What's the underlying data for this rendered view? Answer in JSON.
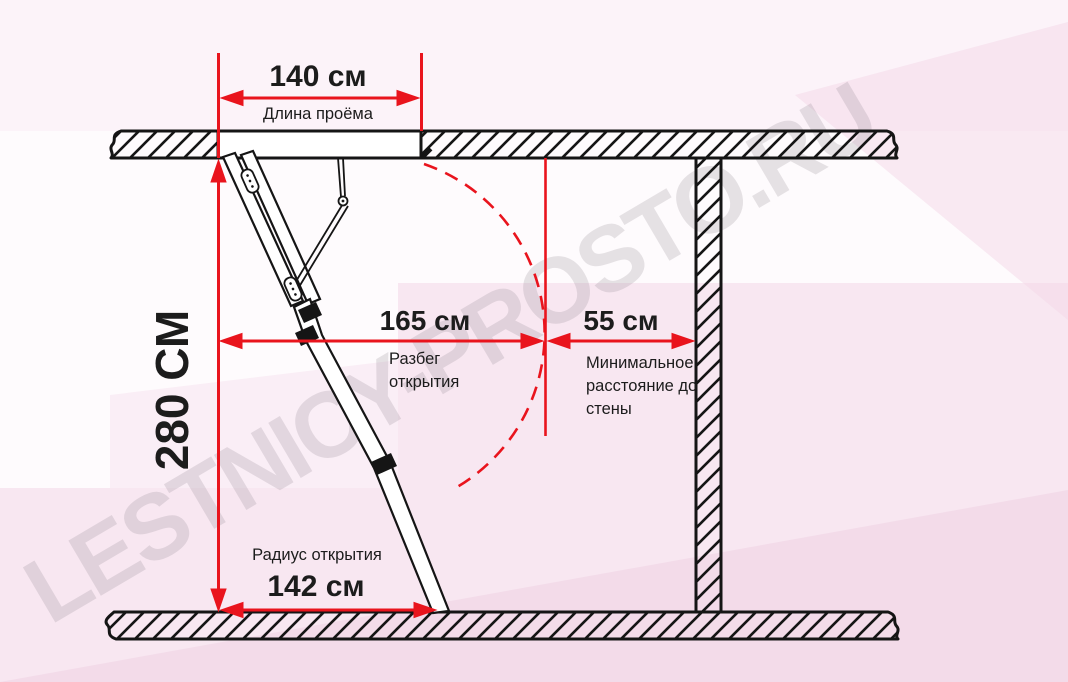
{
  "watermark": {
    "text": "LESTNICY-PROSTO.RU"
  },
  "colors": {
    "dimension_red": "#e9141d",
    "line_black": "#151515",
    "background_pink": "#f3d9e9",
    "watermark_gray": "#e5dfe4"
  },
  "dimensions": {
    "opening_length": {
      "value": "140 см",
      "label": "Длина проёма"
    },
    "ceiling_height": {
      "value": "280 СМ"
    },
    "opening_span": {
      "value": "165 см",
      "label": "Разбег открытия"
    },
    "wall_distance": {
      "value": "55 см",
      "label": "Минимальное расстояние до стены"
    },
    "opening_radius": {
      "value": "142 см",
      "label": "Радиус открытия"
    }
  }
}
